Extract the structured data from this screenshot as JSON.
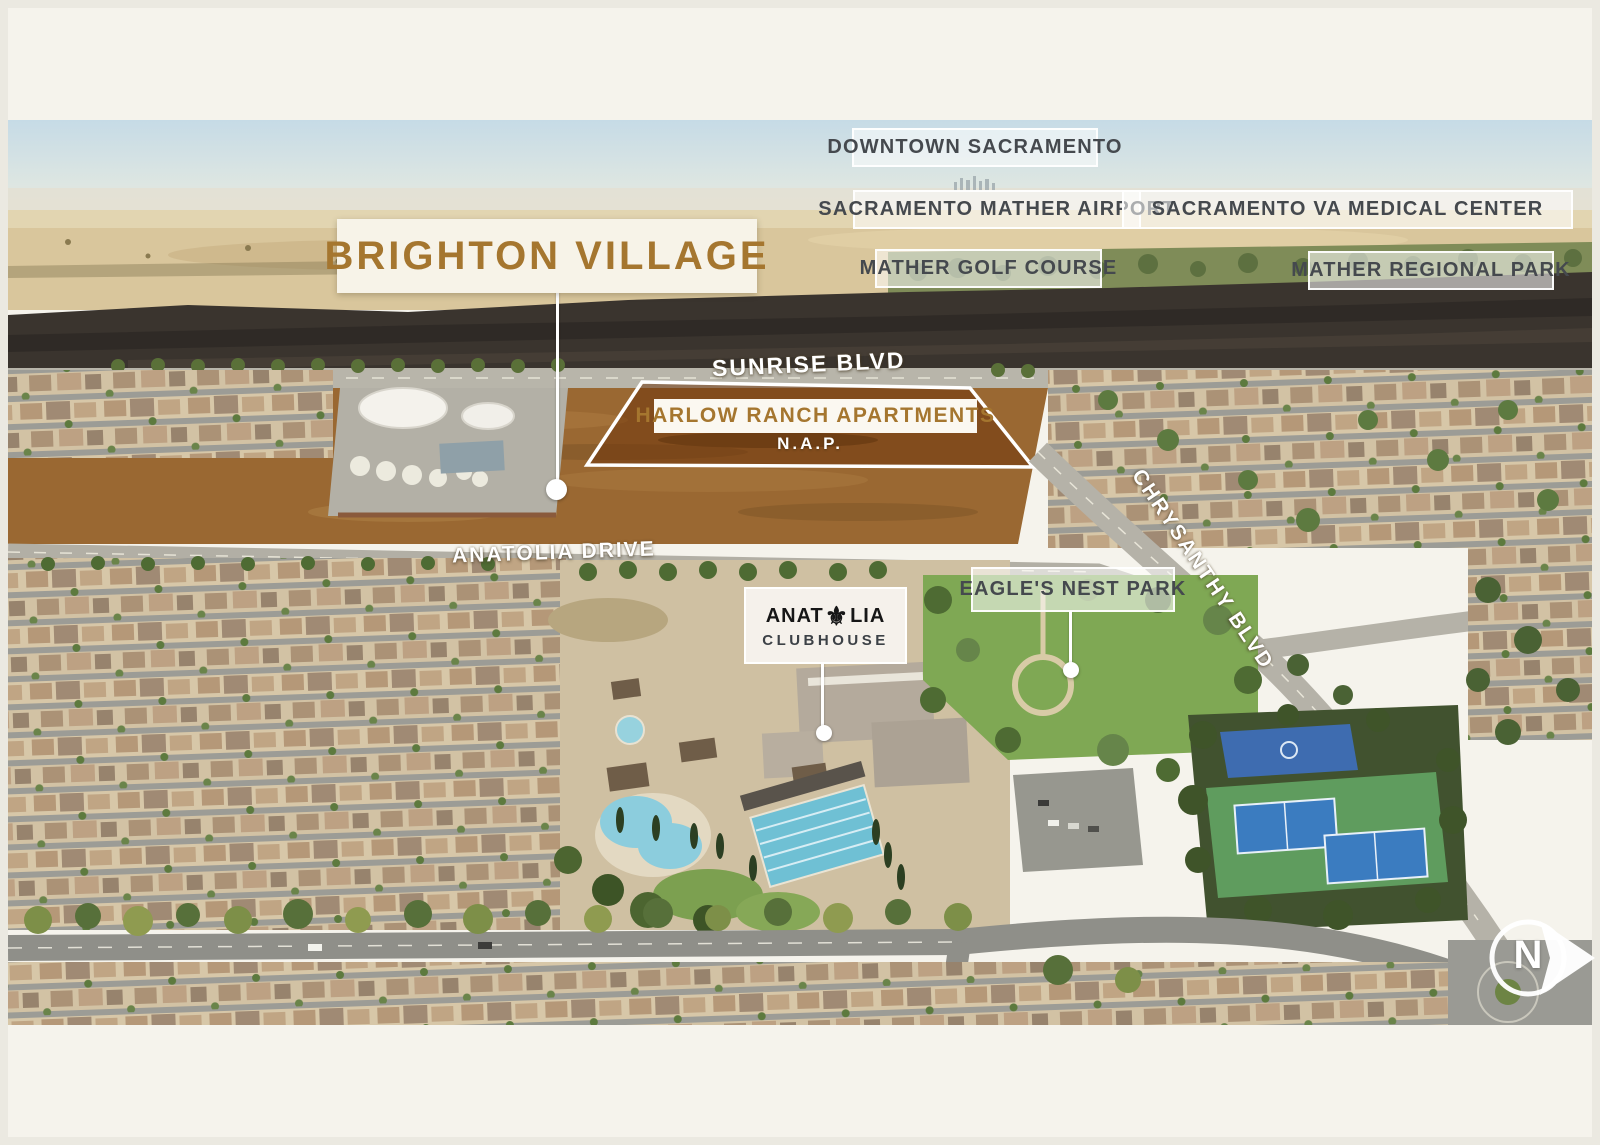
{
  "site": {
    "name": "BRIGHTON VILLAGE",
    "accent_color": "#a5762f"
  },
  "parcel": {
    "name": "HARLOW RANCH APARTMENTS",
    "note": "N.A.P.",
    "overlay_color": "#6e340a"
  },
  "poi_labels": {
    "downtown": "DOWNTOWN SACRAMENTO",
    "mather_airport": "SACRAMENTO MATHER AIRPORT",
    "va_medical_center": "SACRAMENTO VA MEDICAL CENTER",
    "mather_golf_course": "MATHER GOLF COURSE",
    "mather_regional_park": "MATHER REGIONAL PARK",
    "eagles_nest_park": "EAGLE'S NEST PARK"
  },
  "road_labels": {
    "sunrise": "SUNRISE BLVD",
    "anatolia": "ANATOLIA DRIVE",
    "chrysanthy": "CHRYSANTHY BLVD"
  },
  "clubhouse": {
    "brand_prefix": "ANAT",
    "fleur_de_lis": "⚜",
    "brand_suffix": "LIA",
    "subtitle": "CLUBHOUSE"
  },
  "compass": {
    "label": "N"
  }
}
